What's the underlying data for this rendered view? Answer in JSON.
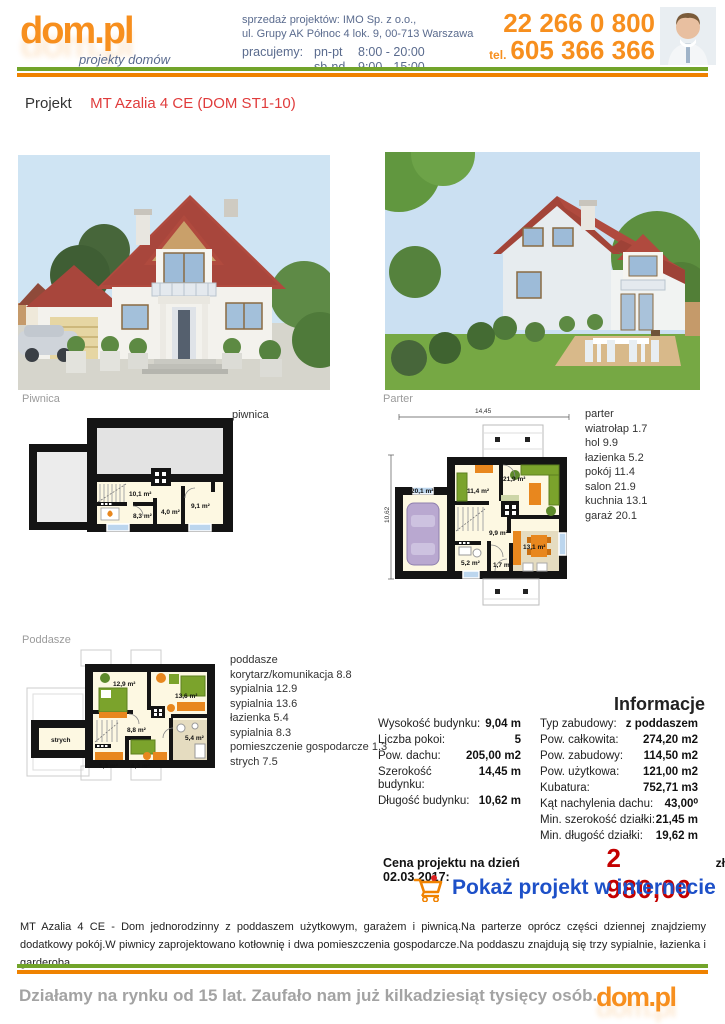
{
  "header": {
    "logo": "dom.pl",
    "logo_tagline": "projekty domów",
    "sales_line1": "sprzedaż projektów: IMO Sp. z o.o.,",
    "sales_line2": "ul. Grupy AK Północ 4 lok. 9, 00-713 Warszawa",
    "hours_label": "pracujemy:",
    "hours_weekdays_label": "pn-pt",
    "hours_weekdays": "8:00 - 20:00",
    "hours_weekend_label": "sb-nd",
    "hours_weekend": "9:00 - 15:00",
    "phone_main": "22 266 0 800",
    "phone_tel_label": "tel.",
    "phone_mobile": "605 366 366"
  },
  "project": {
    "label": "Projekt",
    "name": "MT Azalia 4 CE (DOM ST1-10)"
  },
  "plans": {
    "piwnica": {
      "title": "Piwnica",
      "caption": "piwnica",
      "rooms": [
        "10,1 m²",
        "8,3 m²",
        "4,0 m²",
        "9,1 m²"
      ]
    },
    "parter": {
      "title": "Parter",
      "dims": {
        "width": "14,45",
        "height": "10,62"
      },
      "rooms": [
        "20,1 m²",
        "11,4 m²",
        "21,9 m²",
        "9,9 m²",
        "5,2 m²",
        "1,7 m²",
        "13,1 m²"
      ],
      "legend": [
        "parter",
        "wiatrołap 1.7",
        "hol 9.9",
        "łazienka 5.2",
        "pokój 11.4",
        "salon 21.9",
        "kuchnia 13.1",
        "garaż 20.1"
      ]
    },
    "poddasze": {
      "title": "Poddasze",
      "rooms": [
        "12,9 m²",
        "13,6 m²",
        "8,8 m²",
        "5,4 m²",
        "1,3 m²",
        "8,3 m²",
        "strych"
      ],
      "legend": [
        "poddasze",
        "korytarz/komunikacja 8.8",
        "sypialnia 12.9",
        "sypialnia 13.6",
        "łazienka 5.4",
        "sypialnia 8.3",
        "pomieszczenie gospodarcze 1.3",
        "strych 7.5"
      ]
    }
  },
  "info": {
    "title": "Informacje",
    "left": [
      {
        "label": "Wysokość budynku:",
        "value": "9,04 m"
      },
      {
        "label": "Liczba pokoi:",
        "value": "5"
      },
      {
        "label": "Pow. dachu:",
        "value": "205,00 m2"
      },
      {
        "label": "Szerokość budynku:",
        "value": "14,45 m"
      },
      {
        "label": "Długość budynku:",
        "value": "10,62 m"
      }
    ],
    "right": [
      {
        "label": "Typ zabudowy:",
        "value": "z poddaszem"
      },
      {
        "label": "Pow. całkowita:",
        "value": "274,20 m2"
      },
      {
        "label": "Pow. zabudowy:",
        "value": "114,50 m2"
      },
      {
        "label": "Pow. użytkowa:",
        "value": "121,00 m2"
      },
      {
        "label": "Kubatura:",
        "value": "752,71 m3"
      },
      {
        "label": "Kąt nachylenia dachu:",
        "value": "43,00⁰"
      },
      {
        "label": "Min. szerokość działki:",
        "value": "21,45 m"
      },
      {
        "label": "Min. długość działki:",
        "value": "19,62 m"
      }
    ]
  },
  "price": {
    "label": "Cena projektu na dzień 02.03.2017:",
    "amount": "2 980,00",
    "currency": "zł",
    "cta": "Pokaż projekt w internecie"
  },
  "description": "MT Azalia 4 CE - Dom jednorodzinny z poddaszem użytkowym, garażem i piwnicą.Na parterze oprócz części dziennej znajdziemy dodatkowy pokój.W piwnicy zaprojektowano kotłownię i dwa pomieszczenia gospodarcze.Na poddaszu znajdują się trzy sypialnie, łazienka i garderoba.",
  "footer": {
    "slogan": "Działamy na rynku od 15 lat. Zaufało nam już kilkadziesiąt tysięcy osób.",
    "logo": "dom.pl"
  },
  "icons": {
    "cart_icon": "shopping-cart",
    "agent_photo": "consultant-headshot"
  },
  "colors": {
    "brand_orange": "#f78f1e",
    "line_green": "#72a42a",
    "line_orange": "#ef8200",
    "title_red": "#e03c3c",
    "price_red": "#c40000",
    "link_blue": "#1d50c8",
    "header_text": "#5a6b8e"
  }
}
